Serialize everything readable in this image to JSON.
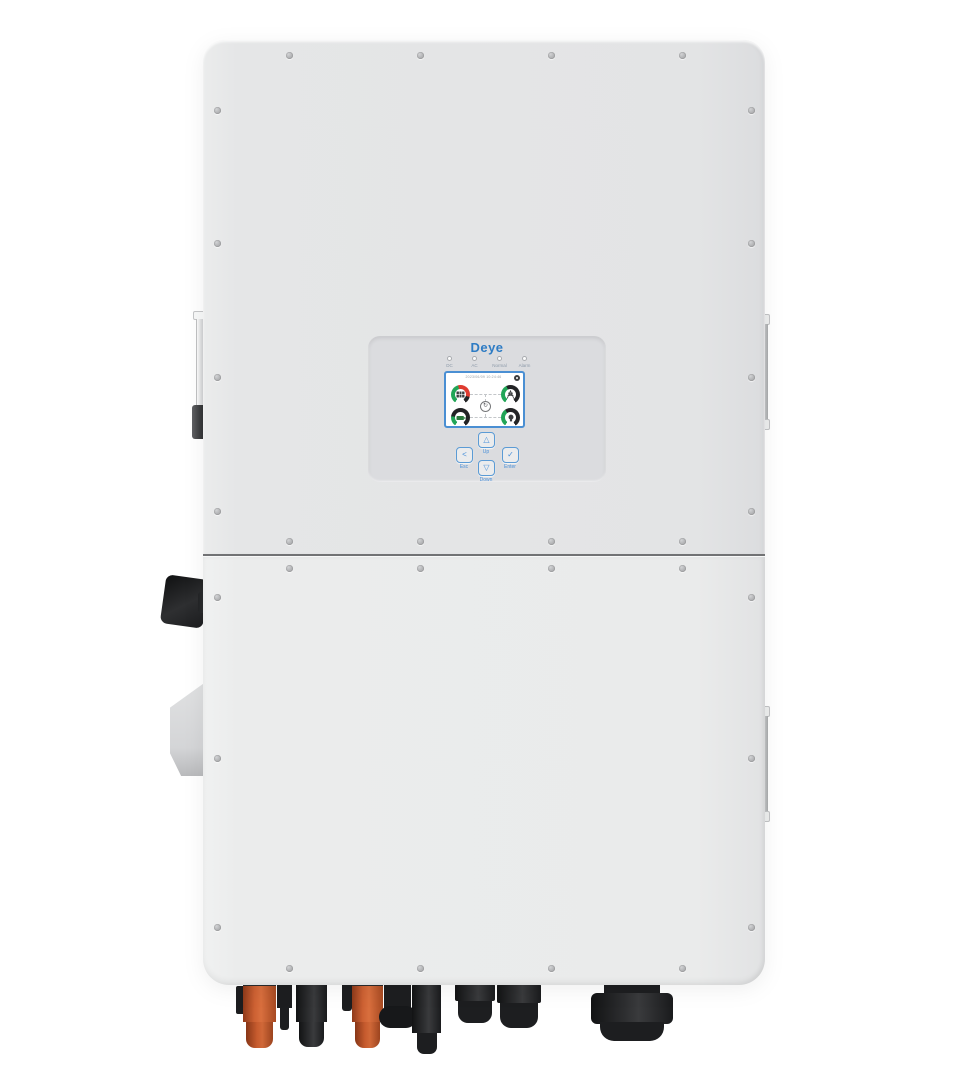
{
  "device": {
    "brand": "Deye",
    "description": "Deye three-phase hybrid inverter, front view"
  },
  "panel": {
    "logo_text": "Deye",
    "leds": [
      {
        "label": "DC"
      },
      {
        "label": "AC"
      },
      {
        "label": "Normal"
      },
      {
        "label": "Alarm"
      }
    ],
    "screen": {
      "status_text": "2023/06/09 10:24:46",
      "gear_icon": "settings-gear",
      "center_glyph": "↻",
      "gauges": [
        {
          "name": "pv",
          "icon": "solar-panel-icon",
          "arc_colors": [
            "#21A557",
            "#DF3B30",
            "#222325"
          ]
        },
        {
          "name": "grid",
          "icon": "grid-tower-icon",
          "arc_colors": [
            "#21A557",
            "#222325"
          ]
        },
        {
          "name": "battery",
          "icon": "battery-icon",
          "arc_colors": [
            "#21A557",
            "#222325"
          ]
        },
        {
          "name": "load",
          "icon": "load-bulb-icon",
          "arc_colors": [
            "#21A557",
            "#222325"
          ]
        }
      ]
    },
    "buttons": [
      {
        "glyph": "<",
        "label": "Esc"
      },
      {
        "glyph": "△",
        "label": "Up"
      },
      {
        "glyph": "▽",
        "label": "Down"
      },
      {
        "glyph": "✓",
        "label": "Enter"
      }
    ]
  },
  "colors": {
    "brand_blue": "#2E7CC4",
    "button_blue": "#4A90D9",
    "body_upper": "#E3E4E5",
    "body_lower": "#EAEBEB",
    "panel_recess": "#DBDCDF",
    "gauge_green": "#21A557",
    "gauge_red": "#DF3B30",
    "gauge_dark": "#222325",
    "connector_orange": "#C65B2E",
    "connector_black": "#1D1E20"
  }
}
